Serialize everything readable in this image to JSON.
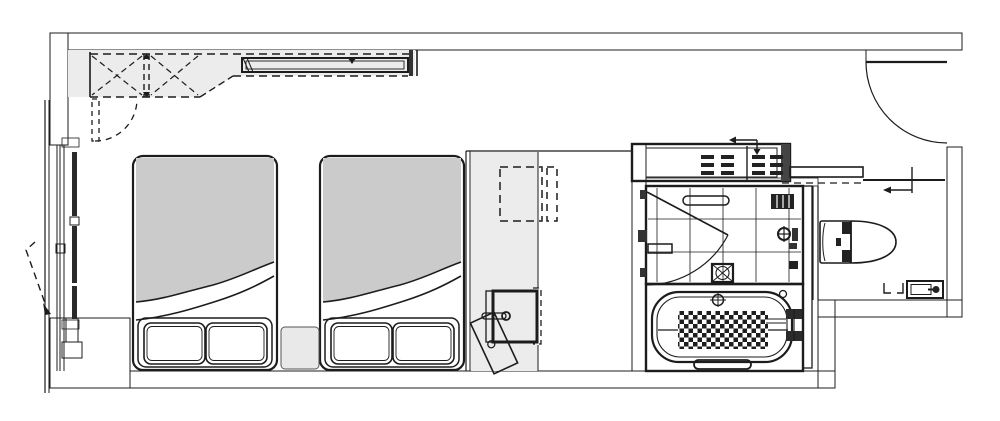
{
  "drawing": {
    "kind": "architectural floor plan",
    "subject": "hotel guest room with twin beds and unit bathroom",
    "visible_text": []
  },
  "palette": {
    "bg": "#ffffff",
    "line": "#1c1c1c",
    "wall_dark": "#6b6b6b",
    "wall_darker": "#585858",
    "wall_mid": "#999999",
    "floor_band": "#9a9a9a",
    "fill_light": "#ececec",
    "duvet": "#cbcbcb",
    "tile": "#f2f2f2",
    "pillow": "#f6f6f6",
    "fixture_dark": "#2b2b2b"
  },
  "fixtures": [
    {
      "name": "closet-with-hanger-rail",
      "style": "dashed overhead outline with X cells"
    },
    {
      "name": "overhead-shelf",
      "style": "solid double-line rail above beds"
    },
    {
      "name": "twin-bed",
      "count": 2,
      "details": "grey duvet, folded sheet, two pillows each"
    },
    {
      "name": "nightstand",
      "count": 1
    },
    {
      "name": "window-wall",
      "details": "left side, mullioned glazing with dashed swing mark"
    },
    {
      "name": "desk-counter",
      "details": "dashed chair outline"
    },
    {
      "name": "washbasin-vanity",
      "details": "bold basin, faucet, dashed mirror edge"
    },
    {
      "name": "tilted-stool"
    },
    {
      "name": "towel-shelf-unit",
      "details": "slatted contents, slide arrow"
    },
    {
      "name": "shower-room",
      "details": "tiled floor, inward swing door, floor drain, mixer, bench"
    },
    {
      "name": "bathtub",
      "details": "anti-slip checker mat, drain, right-hand filler, grab bar"
    },
    {
      "name": "toilet",
      "details": "tank + bowl, paper holder"
    },
    {
      "name": "sliding-door",
      "details": "toilet compartment, arrow marker"
    },
    {
      "name": "entrance-door",
      "details": "top-right quarter-circle swing"
    }
  ]
}
